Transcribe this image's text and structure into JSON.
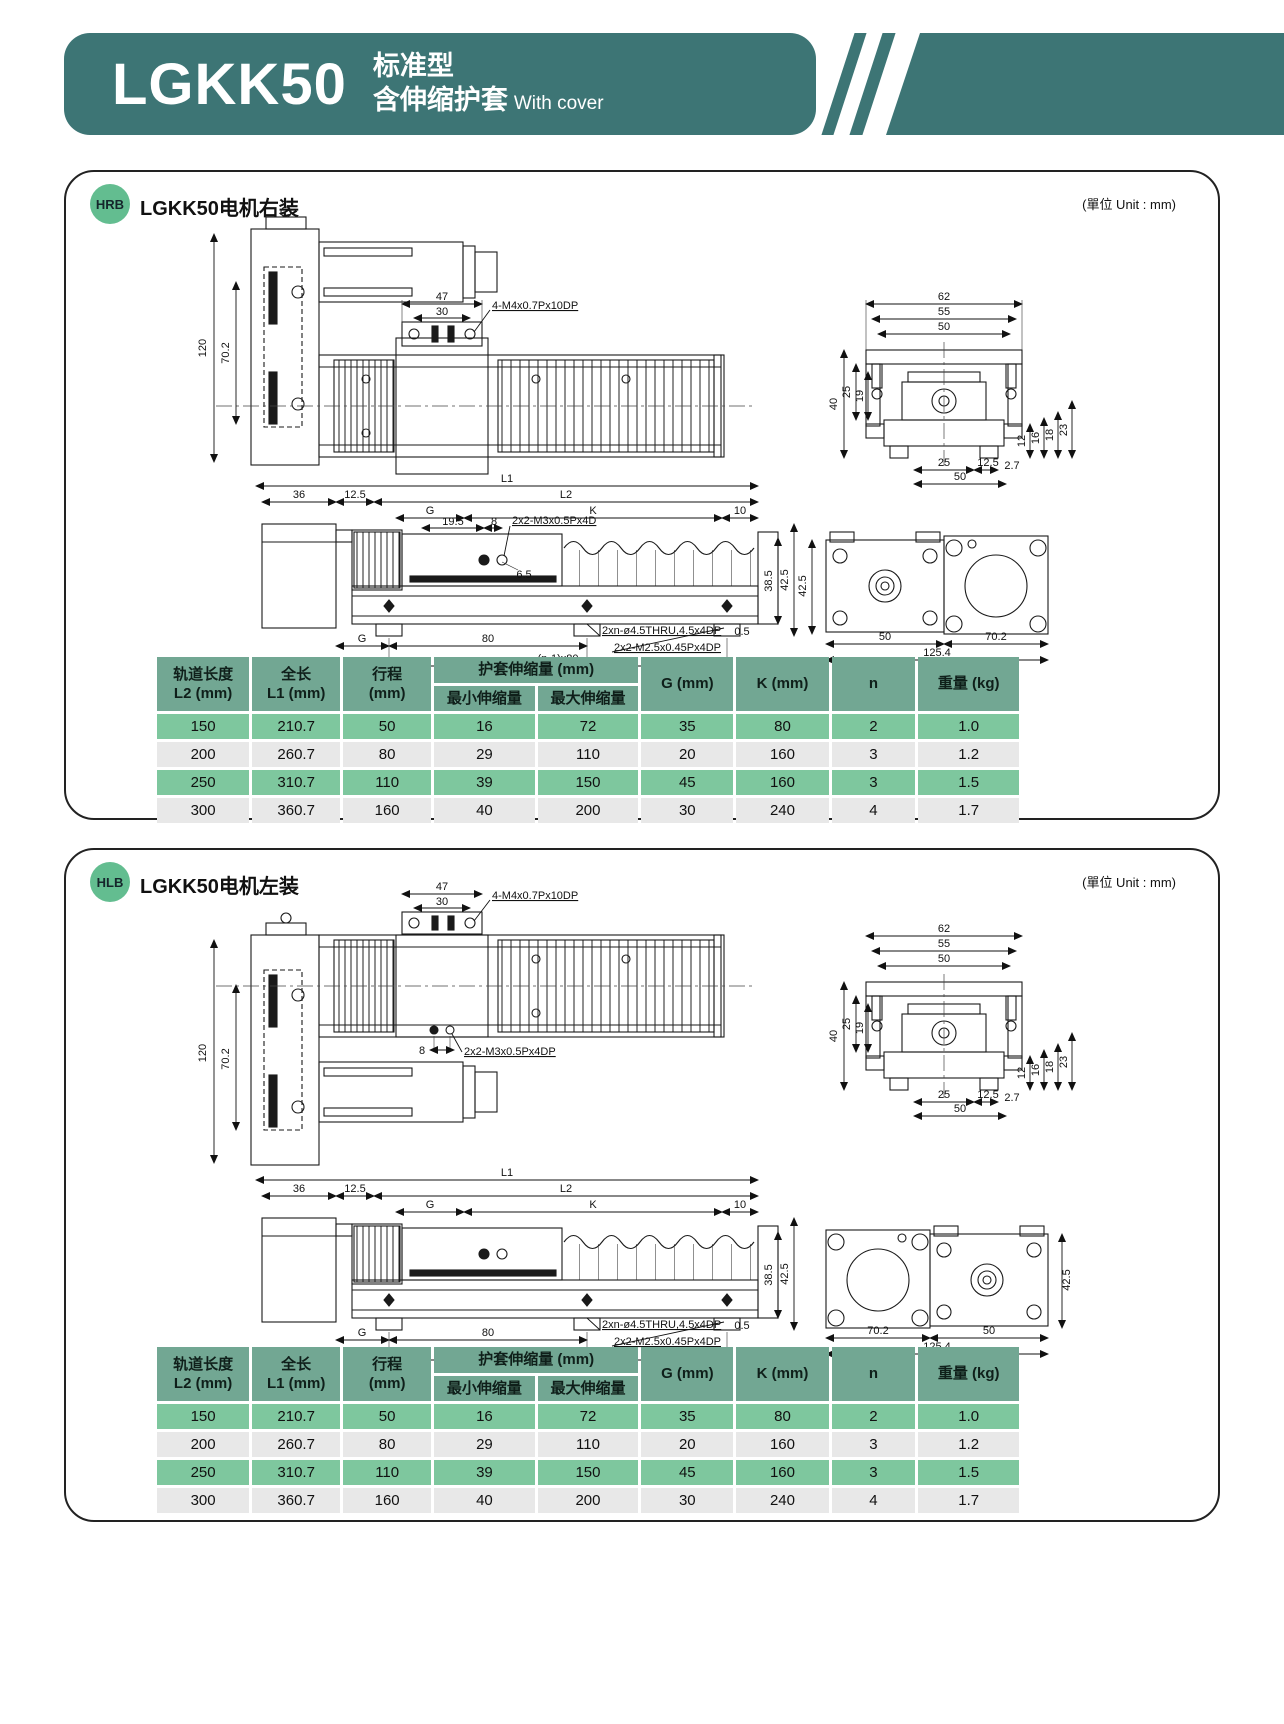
{
  "colors": {
    "banner_teal": "#3d7575",
    "badge_green": "#63bd90",
    "table_header": "#72a793",
    "row_green": "#7ec79e",
    "row_gray": "#e8e8e8",
    "line": "#1a1a1a"
  },
  "banner": {
    "model": "LGKK50",
    "subtitle_line1": "标准型",
    "subtitle_line2": "含伸缩护套",
    "subtitle_en": "With cover"
  },
  "panels": [
    {
      "badge": "HRB",
      "title": "LGKK50电机右装",
      "unit": "(單位 Unit : mm)"
    },
    {
      "badge": "HLB",
      "title": "LGKK50电机左装",
      "unit": "(單位 Unit : mm)"
    }
  ],
  "dims": {
    "d47": "47",
    "d30": "30",
    "m4": "4-M4x0.7Px10DP",
    "d120": "120",
    "d702": "70.2",
    "d62": "62",
    "d55": "55",
    "d50": "50",
    "d40": "40",
    "d25": "25",
    "d19": "19",
    "d12": "12",
    "d16": "16",
    "d18": "18",
    "d23": "23",
    "d125": "12.5",
    "d27": "2.7",
    "L1": "L1",
    "L2": "L2",
    "G": "G",
    "K": "K",
    "d36": "36",
    "d10": "10",
    "d195": "19.5",
    "d8": "8",
    "m3": "2x2-M3x0.5Px4D",
    "m3b": "2x2-M3x0.5Px4DP",
    "d65": "6.5",
    "d385": "38.5",
    "d425": "42.5",
    "d05": "0.5",
    "thru": "2xn-ø4.5THRU,4.5x4DP",
    "m25": "2x2-M2.5x0.45Px4DP",
    "d80": "80",
    "n180": "(n-1)x80",
    "d1254": "125.4"
  },
  "table": {
    "headers": {
      "l2a": "轨道长度",
      "l2b": "L2 (mm)",
      "l1a": "全长",
      "l1b": "L1 (mm)",
      "sta": "行程",
      "stb": "(mm)",
      "cover": "护套伸缩量 (mm)",
      "min": "最小伸缩量",
      "max": "最大伸缩量",
      "g": "G (mm)",
      "k": "K (mm)",
      "n": "n",
      "w": "重量 (kg)"
    },
    "rows": [
      [
        "150",
        "210.7",
        "50",
        "16",
        "72",
        "35",
        "80",
        "2",
        "1.0"
      ],
      [
        "200",
        "260.7",
        "80",
        "29",
        "110",
        "20",
        "160",
        "3",
        "1.2"
      ],
      [
        "250",
        "310.7",
        "110",
        "39",
        "150",
        "45",
        "160",
        "3",
        "1.5"
      ],
      [
        "300",
        "360.7",
        "160",
        "40",
        "200",
        "30",
        "240",
        "4",
        "1.7"
      ]
    ]
  }
}
